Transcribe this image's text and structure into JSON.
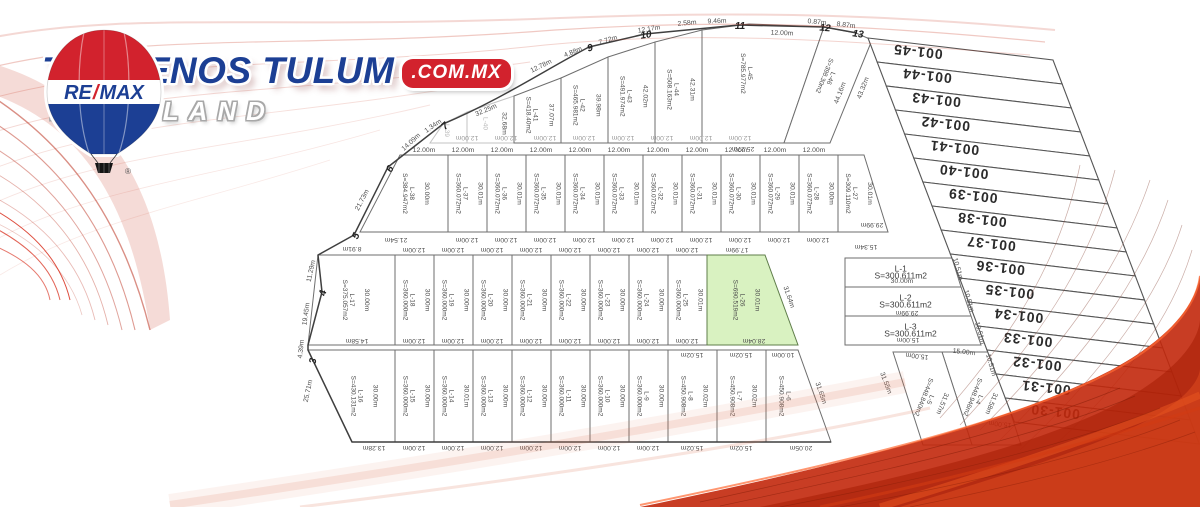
{
  "brand": {
    "remax_re": "RE",
    "remax_slash": "/",
    "remax_max": "MAX",
    "title": "TERRENOS TULUM",
    "title_suffix": ".COM.MX",
    "subtitle": "MAYALAND",
    "registered": "®",
    "colors": {
      "blue": "#1c3f94",
      "red": "#d2222d"
    }
  },
  "plat": {
    "highlight_color": "#d9f2c1",
    "lots": [
      {
        "id": "L-1",
        "label": "L-1",
        "area": "S=300.611m2"
      },
      {
        "id": "L-2",
        "label": "L-2",
        "area": "S=300.611m2"
      },
      {
        "id": "L-3",
        "label": "L-3",
        "area": "S=300.611m2"
      },
      {
        "id": "L-4",
        "label": "L-4",
        "area": "S=448.946m2",
        "dim": "31.58m"
      },
      {
        "id": "L-5",
        "label": "L-5",
        "area": "S=448.840m2",
        "dim": "31.57m"
      },
      {
        "id": "L-6",
        "label": "L-6",
        "area": "S=450.908m2"
      },
      {
        "id": "L-7",
        "label": "L-7",
        "area": "S=450.908m2",
        "depth": "30.02m"
      },
      {
        "id": "L-8",
        "label": "L-8",
        "area": "S=450.908m2",
        "depth": "30.02m"
      },
      {
        "id": "L-9",
        "label": "L-9",
        "area": "S=360.000m2",
        "depth": "30.00m"
      },
      {
        "id": "L-10",
        "label": "L-10",
        "area": "S=360.000m2",
        "depth": "30.00m"
      },
      {
        "id": "L-11",
        "label": "L-11",
        "area": "S=360.000m2",
        "depth": "30.00m"
      },
      {
        "id": "L-12",
        "label": "L-12",
        "area": "S=360.000m2",
        "depth": "30.00m"
      },
      {
        "id": "L-13",
        "label": "L-13",
        "area": "S=360.000m2",
        "depth": "30.00m"
      },
      {
        "id": "L-14",
        "label": "L-14",
        "area": "S=360.000m2",
        "depth": "30.01m"
      },
      {
        "id": "L-15",
        "label": "L-15",
        "area": "S=360.000m2",
        "depth": "30.00m"
      },
      {
        "id": "L-16",
        "label": "L-16",
        "area": "S=430.131m2",
        "depth": "30.00m"
      },
      {
        "id": "L-17",
        "label": "L-17",
        "area": "S=375.057m2",
        "depth": "30.00m"
      },
      {
        "id": "L-18",
        "label": "L-18",
        "area": "S=360.000m2",
        "depth": "30.00m"
      },
      {
        "id": "L-19",
        "label": "L-19",
        "area": "S=360.000m2",
        "depth": "30.00m"
      },
      {
        "id": "L-20",
        "label": "L-20",
        "area": "S=360.000m2",
        "depth": "30.00m"
      },
      {
        "id": "L-21",
        "label": "L-21",
        "area": "S=360.000m2",
        "depth": "30.00m"
      },
      {
        "id": "L-22",
        "label": "L-22",
        "area": "S=360.000m2",
        "depth": "30.00m"
      },
      {
        "id": "L-23",
        "label": "L-23",
        "area": "S=360.000m2",
        "depth": "30.00m"
      },
      {
        "id": "L-24",
        "label": "L-24",
        "area": "S=360.000m2",
        "depth": "30.00m"
      },
      {
        "id": "L-25",
        "label": "L-25",
        "area": "S=360.000m2",
        "depth": "30.01m"
      },
      {
        "id": "L-26",
        "label": "L-26",
        "area": "S=690.519m2",
        "depth": "30.01m",
        "highlight": true
      },
      {
        "id": "L-27",
        "label": "L-27",
        "area": "S=309.110m2",
        "depth": "30.01m"
      },
      {
        "id": "L-28",
        "label": "L-28",
        "area": "S=360.072m2",
        "depth": "30.00m"
      },
      {
        "id": "L-29",
        "label": "L-29",
        "area": "S=360.072m2",
        "depth": "30.01m"
      },
      {
        "id": "L-30",
        "label": "L-30",
        "area": "S=360.072m2",
        "depth": "30.01m"
      },
      {
        "id": "L-31",
        "label": "L-31",
        "area": "S=360.072m2",
        "depth": "30.01m"
      },
      {
        "id": "L-32",
        "label": "L-32",
        "area": "S=360.072m2",
        "depth": "30.01m"
      },
      {
        "id": "L-33",
        "label": "L-33",
        "area": "S=360.072m2",
        "depth": "30.01m"
      },
      {
        "id": "L-34",
        "label": "L-34",
        "area": "S=360.072m2",
        "depth": "30.01m"
      },
      {
        "id": "L-35",
        "label": "L-35",
        "area": "S=360.072m2",
        "depth": "30.01m"
      },
      {
        "id": "L-36",
        "label": "L-36",
        "area": "S=360.072m2",
        "depth": "30.01m"
      },
      {
        "id": "L-37",
        "label": "L-37",
        "area": "S=360.072m2",
        "depth": "30.01m"
      },
      {
        "id": "L-38",
        "label": "L-38",
        "area": "S=384.947m2",
        "depth": "30.00m"
      },
      {
        "id": "L-39",
        "label": "L-39",
        "faint": true
      },
      {
        "id": "L-40",
        "label": "L-40",
        "dim": "32.68m",
        "faint": true
      },
      {
        "id": "L-41",
        "label": "L-41",
        "area": "S=418.40m2",
        "dim": "37.07m"
      },
      {
        "id": "L-42",
        "label": "L-42",
        "area": "S=465.981m2",
        "dim": "39.98m"
      },
      {
        "id": "L-43",
        "label": "L-43",
        "area": "S=491.974m2",
        "dim": "42.02m"
      },
      {
        "id": "L-44",
        "label": "L-44",
        "area": "S=508.163m2",
        "dim": "42.31m"
      },
      {
        "id": "L-45",
        "label": "L-45",
        "area": "S=785.977m2"
      },
      {
        "id": "L-46",
        "label": "L-46",
        "area": "S=398.30m2"
      }
    ],
    "strip_labels": [
      "001-45",
      "001-44",
      "001-43",
      "001-42",
      "001-41",
      "001-40",
      "001-39",
      "001-38",
      "001-37",
      "001-36",
      "001-35",
      "001-34",
      "001-33",
      "001-32",
      "001-31",
      "001-30"
    ],
    "dims": [
      "21.73m",
      "14.09m",
      "1.34m",
      "32.25m",
      "12.78m",
      "4.88m",
      "7.72m",
      "12.17m",
      "2.58m",
      "9.46m",
      "12.00m",
      "0.87m",
      "8.87m",
      "25.27m",
      "44.16m",
      "43.32m",
      "8.91m",
      "21.54m",
      "15.34m",
      "29.99m",
      "29.99m",
      "30.00m",
      "15.00m",
      "15.00m",
      "15.00m",
      "31.55m",
      "15.00m",
      "31.64m",
      "31.65m",
      "10.51m",
      "10.51m",
      "10.51m",
      "10.51m",
      "13.28m",
      "15.02m",
      "15.02m",
      "20.05m",
      "15.02m",
      "15.02m",
      "10.00m",
      "14.58m",
      "28.04m",
      "17.99m",
      "11.29m",
      "19.45m",
      "4.39m",
      "25.71m"
    ],
    "repeat_dims": [
      {
        "text": "12.00m",
        "count": 8
      },
      {
        "text": "12.00m",
        "count": 11
      },
      {
        "text": "12.00m",
        "count": 10
      },
      {
        "text": "12.00m",
        "count": 8
      },
      {
        "text": "12.00m",
        "count": 8
      },
      {
        "text": "12.00m",
        "count": 7
      }
    ],
    "vertex_labels": [
      "3",
      "4",
      "5",
      "6",
      "7",
      "9",
      "10",
      "11",
      "12",
      "13"
    ]
  }
}
